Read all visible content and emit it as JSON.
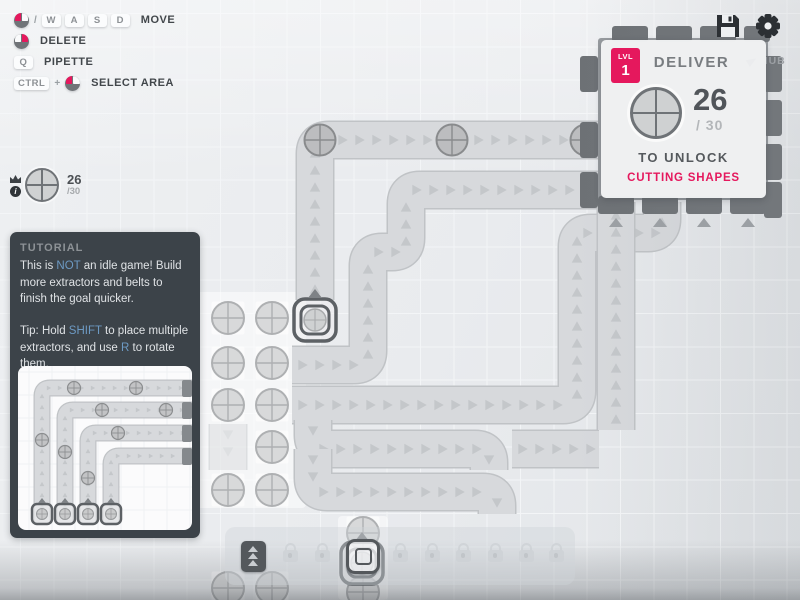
{
  "colors": {
    "accent": "#e5185d",
    "link": "#6d9ac4",
    "belt_fill": "#d7d9dc",
    "belt_outline": "#c0c3c6",
    "chevron": "#c4c7ca",
    "deposit_fill": "#d8d9da",
    "deposit_stroke": "#aeb0b2",
    "item_fill": "#bcbdbf",
    "item_stroke": "#898b8d",
    "extractor_ring": "#5d6165",
    "extractor_arrow": "#7e8286",
    "hub_body": "#989ca0",
    "hub_tab": "#6d7175",
    "hub_tab_arrow": "#9ca0a4",
    "patch_overlay": "rgba(255,255,255,0.5)"
  },
  "hud": {
    "keybinds": [
      {
        "action": "MOVE",
        "keys": [
          {
            "mouse": "left"
          },
          {
            "sep": "/"
          },
          {
            "key": "W"
          },
          {
            "key": "A"
          },
          {
            "key": "S"
          },
          {
            "key": "D"
          }
        ]
      },
      {
        "action": "DELETE",
        "keys": [
          {
            "mouse": "right"
          }
        ]
      },
      {
        "action": "PIPETTE",
        "keys": [
          {
            "key": "Q"
          }
        ]
      },
      {
        "action": "SELECT AREA",
        "keys": [
          {
            "key": "CTRL"
          },
          {
            "sep": "+"
          },
          {
            "mouse": "left"
          }
        ]
      }
    ],
    "pinned_goal": {
      "shape": "circle",
      "amount": "26",
      "total": "/30"
    },
    "hub_label": "HUB",
    "icons": [
      "save-icon",
      "gear-icon"
    ]
  },
  "goal_panel": {
    "level_label": "LVL",
    "level": "1",
    "title": "DELIVER",
    "shape": "circle",
    "amount": "26",
    "total": "/ 30",
    "unlock_text": "TO UNLOCK",
    "reward": "CUTTING SHAPES"
  },
  "tutorial": {
    "title": "TUTORIAL",
    "paragraphs": [
      [
        {
          "t": "This is "
        },
        {
          "t": "NOT",
          "hl": true
        },
        {
          "t": " an idle game! Build more extractors and belts to finish the goal quicker."
        }
      ],
      [
        {
          "t": "Tip: Hold "
        },
        {
          "t": "SHIFT",
          "hl": true
        },
        {
          "t": " to place multiple extractors, and use "
        },
        {
          "t": "R",
          "hl": true
        },
        {
          "t": " to rotate them."
        }
      ]
    ],
    "image": {
      "w": 174,
      "h": 164,
      "belts": [
        {
          "points": [
            [
              24,
              158
            ],
            [
              24,
              22
            ],
            [
              174,
              22
            ]
          ]
        },
        {
          "points": [
            [
              47,
              158
            ],
            [
              47,
              44
            ],
            [
              174,
              44
            ]
          ]
        },
        {
          "points": [
            [
              70,
              158
            ],
            [
              70,
              67
            ],
            [
              174,
              67
            ]
          ]
        },
        {
          "points": [
            [
              93,
              158
            ],
            [
              93,
              90
            ],
            [
              174,
              90
            ]
          ]
        }
      ],
      "items": [
        [
          56,
          22
        ],
        [
          118,
          22
        ],
        [
          84,
          44
        ],
        [
          148,
          44
        ],
        [
          24,
          74
        ],
        [
          100,
          67
        ],
        [
          47,
          86
        ],
        [
          70,
          112
        ]
      ],
      "extractors": [
        [
          24,
          148
        ],
        [
          47,
          148
        ],
        [
          70,
          148
        ],
        [
          93,
          148
        ]
      ],
      "stubs": [
        [
          164,
          14
        ],
        [
          164,
          36
        ],
        [
          164,
          59
        ],
        [
          164,
          82
        ]
      ]
    }
  },
  "toolbar": {
    "slots": [
      {
        "type": "belt",
        "x": 253
      },
      {
        "type": "locked",
        "x": 290
      },
      {
        "type": "locked",
        "x": 322
      },
      {
        "type": "extractor",
        "x": 363,
        "selected": true
      },
      {
        "type": "locked",
        "x": 400
      },
      {
        "type": "locked",
        "x": 432
      },
      {
        "type": "locked",
        "x": 463
      },
      {
        "type": "locked",
        "x": 495
      },
      {
        "type": "locked",
        "x": 526
      },
      {
        "type": "locked",
        "x": 556
      }
    ]
  },
  "map": {
    "patches": [
      {
        "x": 194,
        "y": 292,
        "w": 112,
        "h": 216
      },
      {
        "x": 338,
        "y": 516,
        "w": 50,
        "h": 84
      }
    ],
    "belts": [
      {
        "points": [
          [
            315,
            300
          ],
          [
            315,
            140
          ],
          [
            600,
            140
          ]
        ],
        "items": [
          [
            320,
            140
          ],
          [
            452,
            140
          ],
          [
            586,
            140
          ]
        ]
      },
      {
        "points": [
          [
            292,
            365
          ],
          [
            368,
            365
          ],
          [
            368,
            252
          ],
          [
            406,
            252
          ],
          [
            406,
            190
          ],
          [
            600,
            190
          ]
        ],
        "items": []
      },
      {
        "points": [
          [
            292,
            405
          ],
          [
            577,
            405
          ],
          [
            577,
            233
          ],
          [
            662,
            233
          ],
          [
            662,
            202
          ]
        ],
        "items": []
      },
      {
        "points": [
          [
            512,
            449
          ],
          [
            599,
            449
          ]
        ],
        "items": []
      },
      {
        "points": [
          [
            616,
            430
          ],
          [
            616,
            202
          ]
        ],
        "items": []
      },
      {
        "points": [
          [
            313,
            420
          ],
          [
            313,
            449
          ],
          [
            489,
            449
          ],
          [
            489,
            470
          ]
        ],
        "items": []
      },
      {
        "points": [
          [
            313,
            449
          ],
          [
            313,
            492
          ],
          [
            497,
            492
          ],
          [
            497,
            514
          ]
        ],
        "items": []
      }
    ],
    "ghost_belts": [
      {
        "points": [
          [
            228,
            424
          ],
          [
            228,
            470
          ]
        ]
      }
    ],
    "deposits": [
      [
        228,
        318
      ],
      [
        272,
        318
      ],
      [
        228,
        363
      ],
      [
        272,
        363
      ],
      [
        228,
        405
      ],
      [
        272,
        405
      ],
      [
        272,
        447
      ],
      [
        228,
        490
      ],
      [
        272,
        490
      ],
      [
        363,
        533
      ],
      [
        363,
        592
      ],
      [
        228,
        588
      ],
      [
        272,
        588
      ]
    ],
    "extractors": [
      {
        "cx": 315,
        "cy": 320
      },
      {
        "cx": 362,
        "cy": 563
      }
    ],
    "hub": {
      "body": {
        "x": 598,
        "y": 38,
        "w": 170,
        "h": 162
      },
      "tabs": [
        {
          "x": 612,
          "y": 26,
          "w": 36,
          "h": 16
        },
        {
          "x": 656,
          "y": 26,
          "w": 36,
          "h": 16
        },
        {
          "x": 700,
          "y": 26,
          "w": 36,
          "h": 16
        },
        {
          "x": 744,
          "y": 26,
          "w": 26,
          "h": 16
        },
        {
          "x": 598,
          "y": 196,
          "w": 36,
          "h": 18
        },
        {
          "x": 642,
          "y": 196,
          "w": 36,
          "h": 18
        },
        {
          "x": 686,
          "y": 196,
          "w": 36,
          "h": 18
        },
        {
          "x": 730,
          "y": 196,
          "w": 36,
          "h": 18
        },
        {
          "x": 580,
          "y": 56,
          "w": 18,
          "h": 36
        },
        {
          "x": 580,
          "y": 122,
          "w": 18,
          "h": 36
        },
        {
          "x": 580,
          "y": 172,
          "w": 18,
          "h": 36
        },
        {
          "x": 764,
          "y": 56,
          "w": 18,
          "h": 36
        },
        {
          "x": 764,
          "y": 100,
          "w": 18,
          "h": 36
        },
        {
          "x": 764,
          "y": 144,
          "w": 18,
          "h": 36
        },
        {
          "x": 764,
          "y": 182,
          "w": 18,
          "h": 36
        }
      ],
      "bottom_arrows": [
        [
          616,
          222
        ],
        [
          660,
          222
        ],
        [
          704,
          222
        ],
        [
          748,
          222
        ]
      ]
    }
  }
}
